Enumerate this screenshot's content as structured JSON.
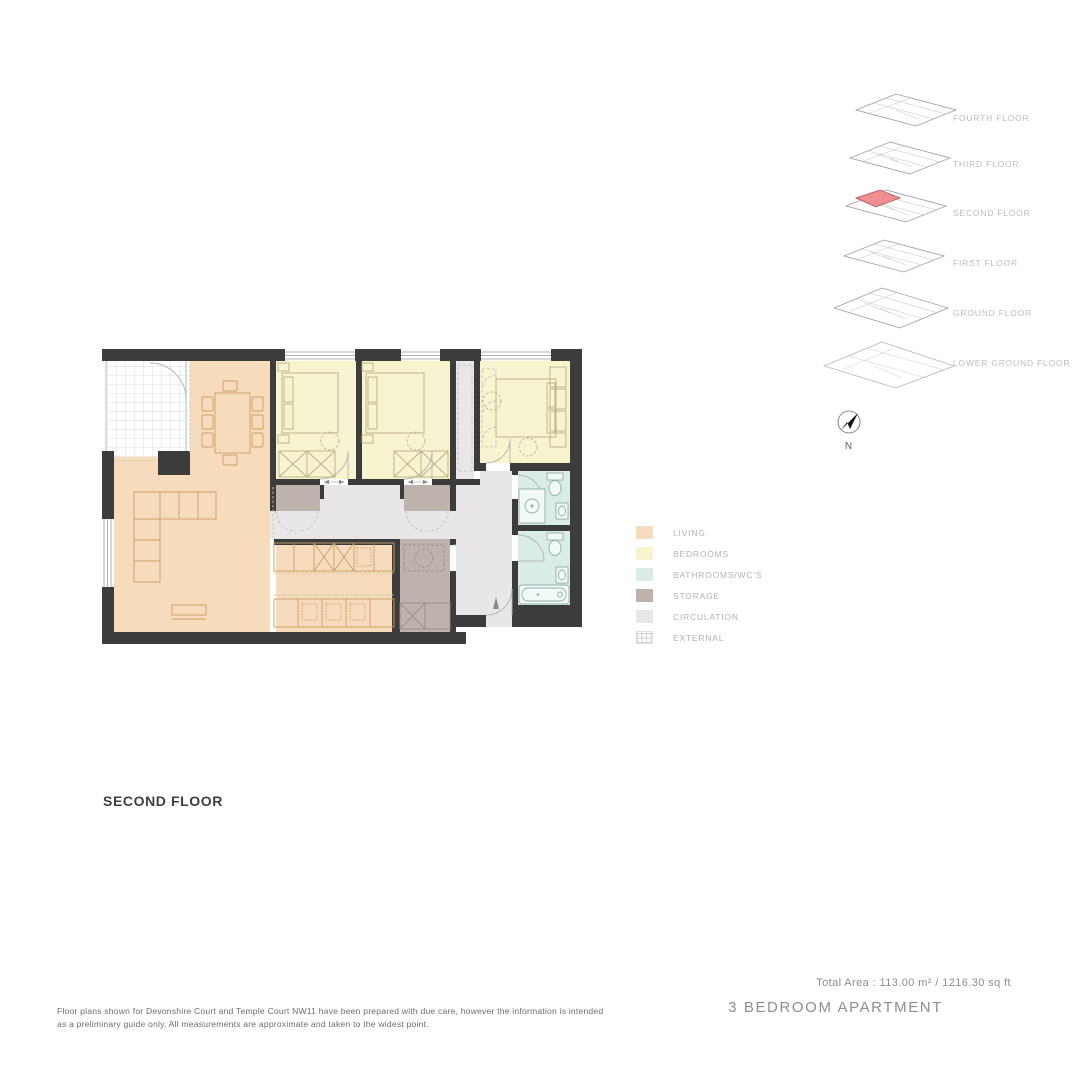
{
  "title": {
    "floor_label": "SECOND FLOOR"
  },
  "summary": {
    "total_area": "Total Area : 113.00 m² / 1216.30 sq ft",
    "apartment_type": "3 BEDROOM APARTMENT"
  },
  "disclaimer": "Floor plans shown for Devonshire Court and Temple Court NW11 have been prepared with due care, however the information is intended as a preliminary guide only. All measurements are approximate and taken to the widest point.",
  "compass": {
    "label": "N"
  },
  "floor_stack": {
    "floors": [
      {
        "label": "FOURTH FLOOR"
      },
      {
        "label": "THIRD FLOOR"
      },
      {
        "label": "SECOND FLOOR"
      },
      {
        "label": "FIRST FLOOR"
      },
      {
        "label": "GROUND FLOOR"
      },
      {
        "label": "LOWER GROUND FLOOR"
      }
    ],
    "highlighted_floor": "SECOND FLOOR",
    "highlight_color": "#ee8e8f",
    "highlight_stroke": "#b05052"
  },
  "legend": {
    "items": [
      {
        "key": "living",
        "label": "LIVING",
        "color": "#f6dcbd"
      },
      {
        "key": "bedrooms",
        "label": "BEDROOMS",
        "color": "#f8f4d0"
      },
      {
        "key": "bathrooms",
        "label": "BATHROOMS/WC'S",
        "color": "#d9ece7"
      },
      {
        "key": "storage",
        "label": "STORAGE",
        "color": "#bdb2ac"
      },
      {
        "key": "circulation",
        "label": "CIRCULATION",
        "color": "#e9e6e8"
      },
      {
        "key": "external",
        "label": "EXTERNAL",
        "color": "#ffffff"
      }
    ]
  },
  "colors": {
    "wall": "#3c3c3c",
    "window_line": "#9a9a9a",
    "door_line": "#b3b3b3",
    "furniture_living": "#c99f66",
    "furniture_bedroom": "#b9ae84",
    "fixture": "#8fafa9",
    "dashed_decor": "#cfc3a5"
  }
}
